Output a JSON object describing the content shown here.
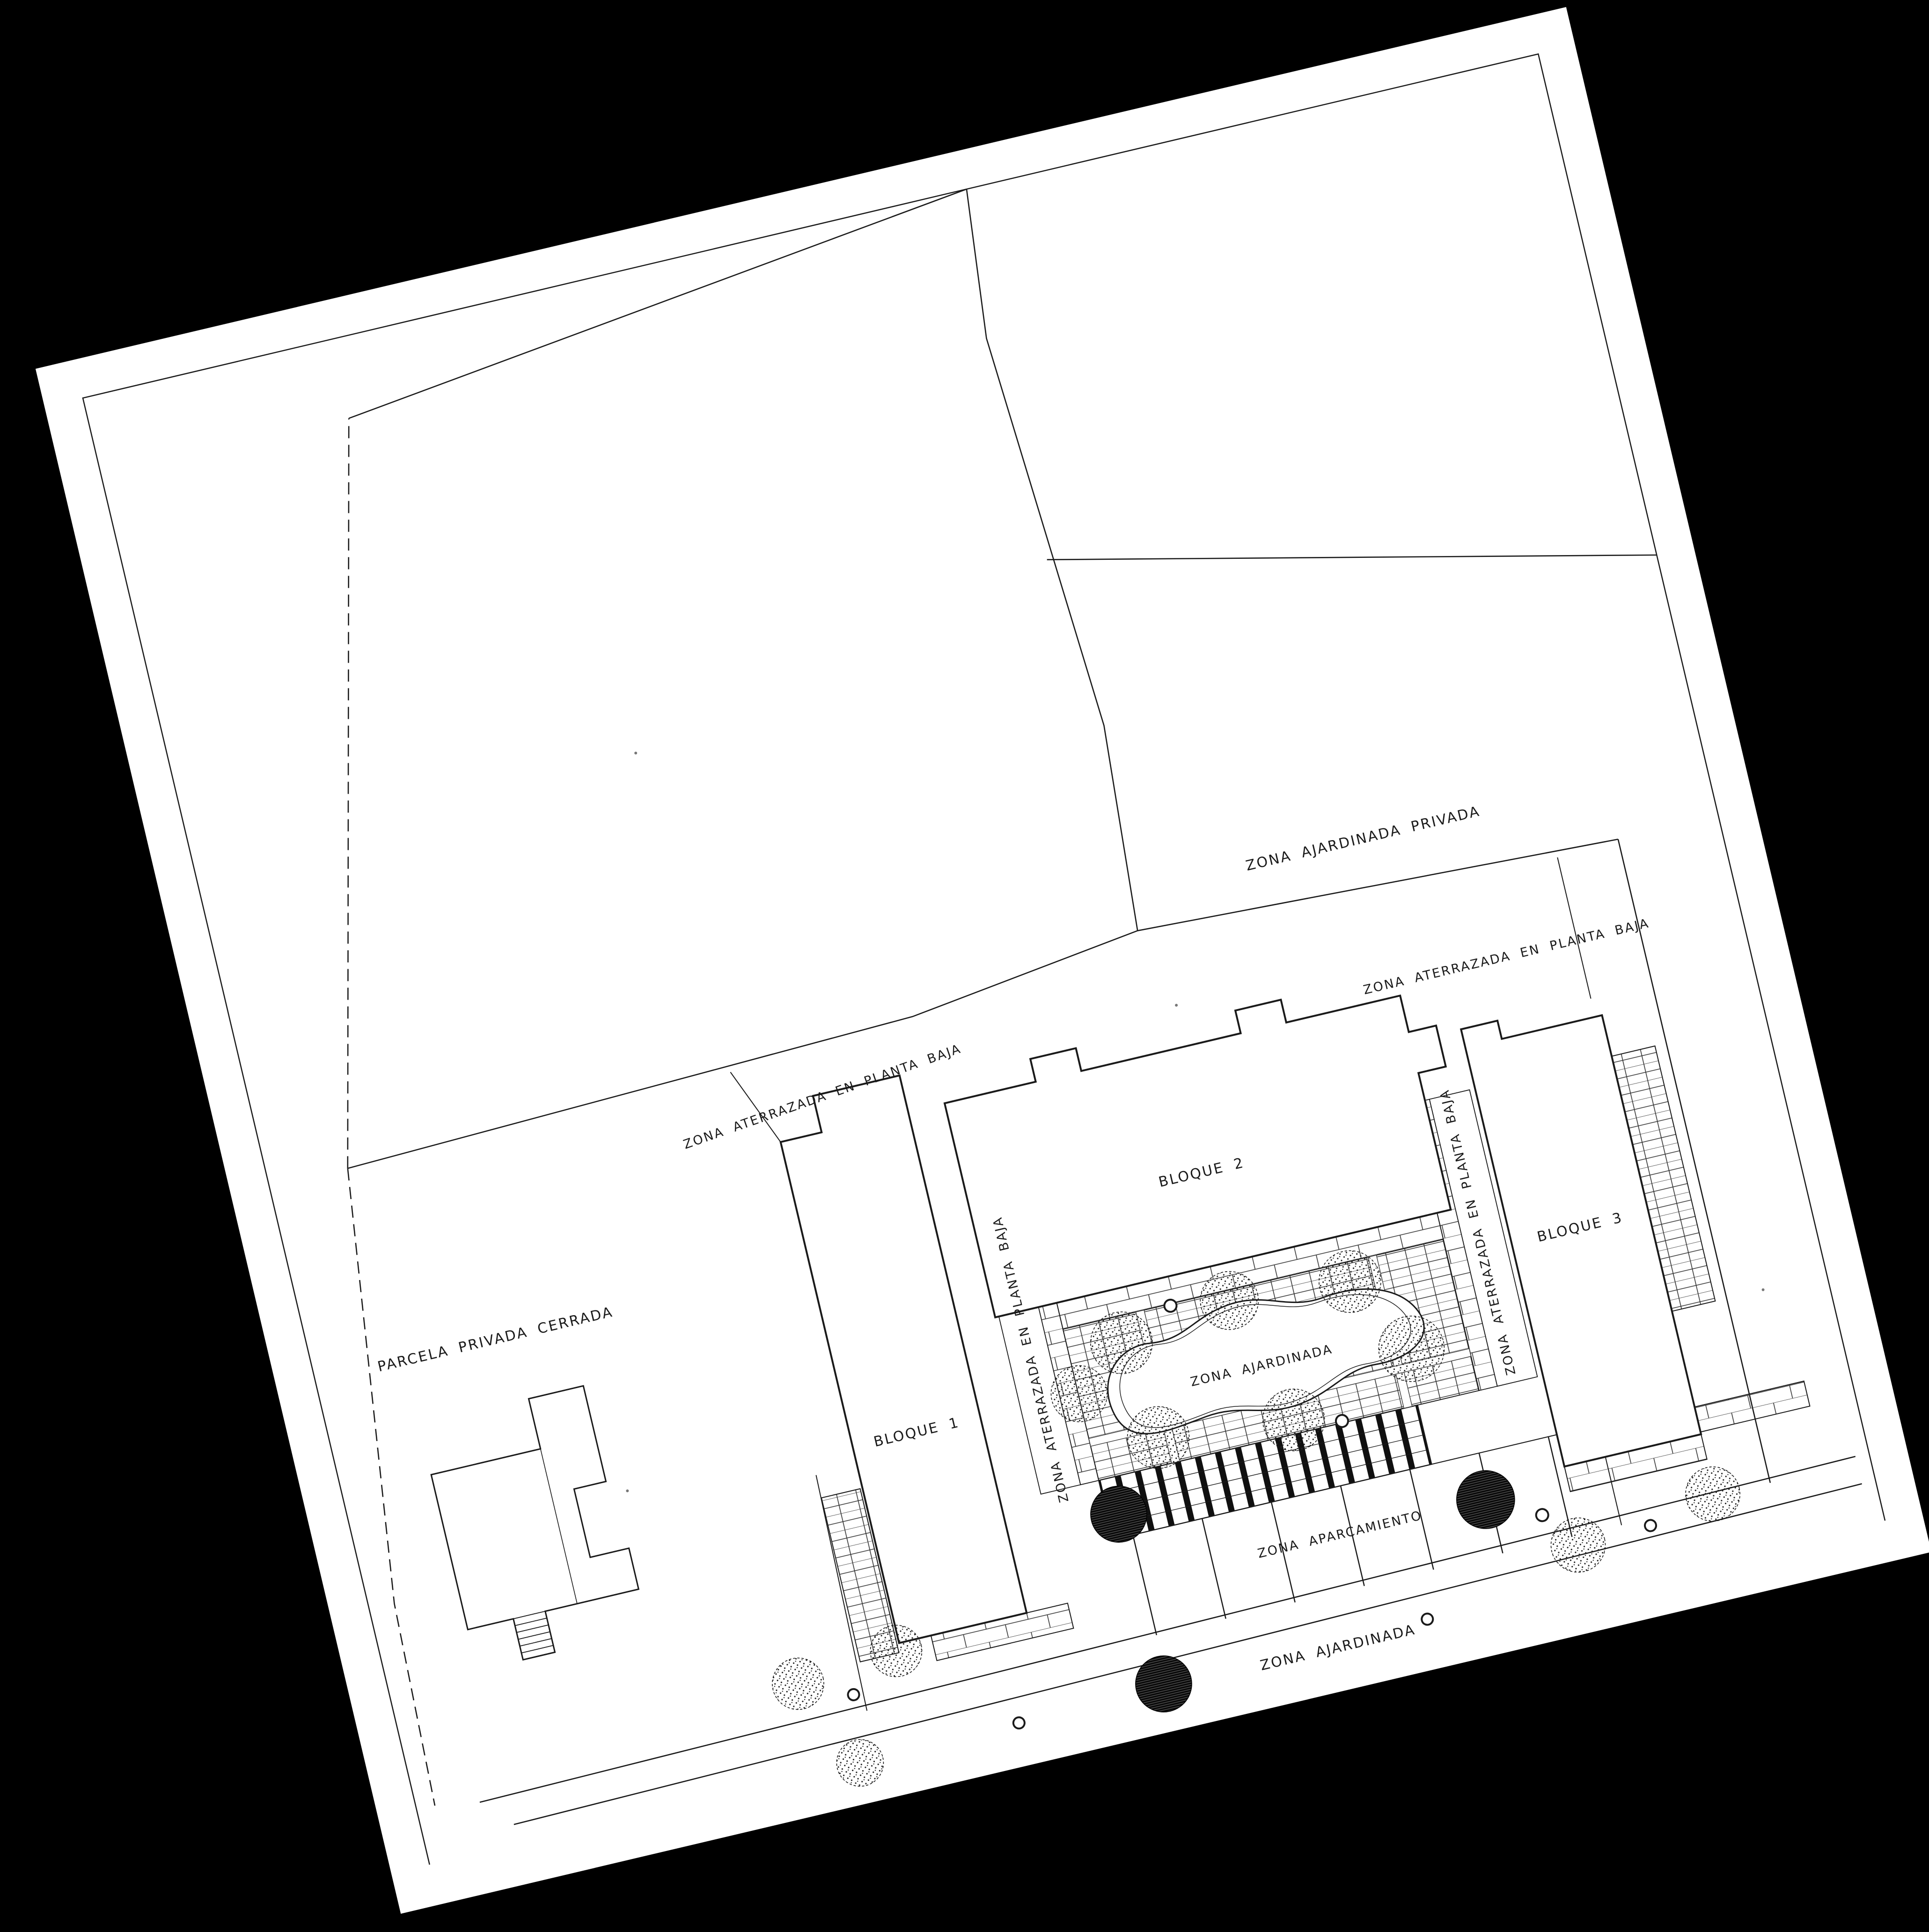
{
  "document": {
    "kind": "scanned architectural site plan",
    "language": "Spanish",
    "paper_color": "#ffffff",
    "background_color": "#000000",
    "ink_color": "#1a1a1a"
  },
  "labels": {
    "zona_ajardinada_privada": "ZONA AJARDINADA PRIVADA",
    "zona_aterrazada_ne": "ZONA ATERRAZADA EN PLANTA BAJA",
    "zona_aterrazada_nw": "ZONA ATERRAZADA EN PLANTA BAJA",
    "zona_aterrazada_west": "ZONA ATERRAZADA EN PLANTA BAJA",
    "zona_aterrazada_east": "ZONA ATERRAZADA EN PLANTA BAJA",
    "bloque1": "BLOQUE 1",
    "bloque2": "BLOQUE 2",
    "bloque3": "BLOQUE 3",
    "parcela_privada_cerrada": "PARCELA PRIVADA CERRADA",
    "zona_ajardinada_centro": "ZONA AJARDINADA",
    "zona_aparcamiento": "ZONA APARCAMIENTO",
    "zona_ajardinada_calle": "ZONA AJARDINADA"
  }
}
